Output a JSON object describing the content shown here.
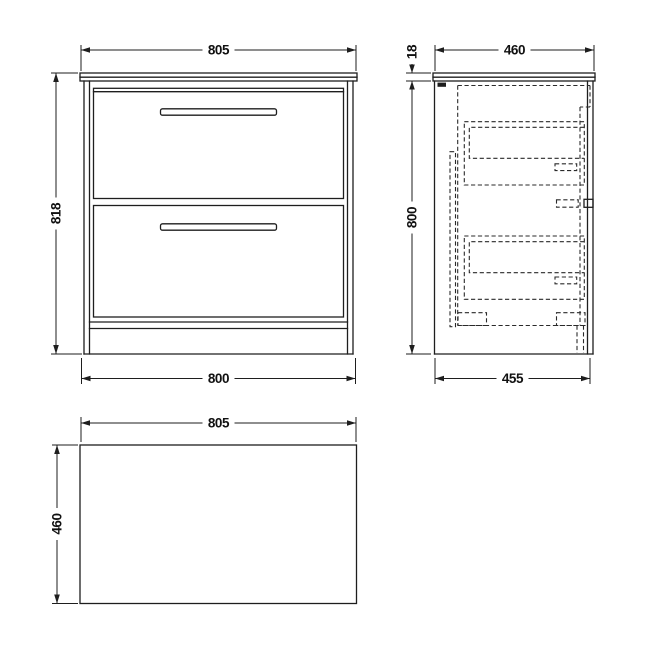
{
  "drawing": {
    "type": "furniture-technical-drawing",
    "views": [
      "front",
      "side",
      "plan"
    ],
    "colors": {
      "line": "#1e1e1e",
      "hidden_line": "#2a2a2a",
      "background": "#ffffff"
    }
  },
  "labels": {
    "front": {
      "width_top": "805",
      "height": "818",
      "width_bottom": "800"
    },
    "side": {
      "depth_top": "460",
      "worktop_thickness": "18",
      "height": "800",
      "depth_bottom": "455"
    },
    "plan": {
      "width": "805",
      "depth": "460"
    }
  }
}
